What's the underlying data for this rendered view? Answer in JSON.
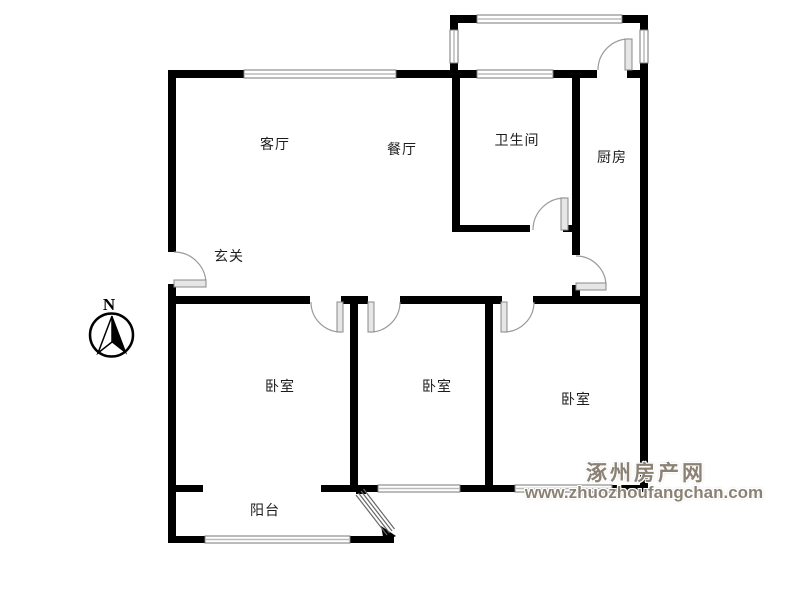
{
  "plan": {
    "type": "residential-floor-plan",
    "rooms": [
      {
        "id": "living-room",
        "label": "客厅"
      },
      {
        "id": "dining-room",
        "label": "餐厅"
      },
      {
        "id": "bathroom",
        "label": "卫生间"
      },
      {
        "id": "kitchen",
        "label": "厨房"
      },
      {
        "id": "entry",
        "label": "玄关"
      },
      {
        "id": "bedroom-1",
        "label": "卧室"
      },
      {
        "id": "bedroom-2",
        "label": "卧室"
      },
      {
        "id": "bedroom-3",
        "label": "卧室"
      },
      {
        "id": "balcony",
        "label": "阳台"
      }
    ],
    "compass": {
      "label": "N"
    },
    "watermark": {
      "site_name": "涿州房产网",
      "site_url": "www.zhuozhoufangchan.com"
    },
    "colors": {
      "wall": "#000000",
      "window_line": "#8c8c8c",
      "door_arc": "#9a9a9a",
      "door_leaf_fill": "#e6e6e6",
      "label_text": "#1c1c1c",
      "watermark_gray": "#8b8275"
    }
  }
}
